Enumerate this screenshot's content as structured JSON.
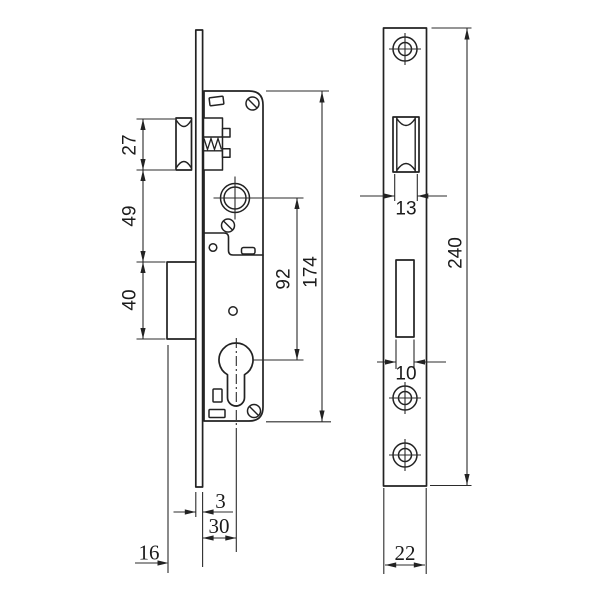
{
  "drawing_title": "mortise lock dimension drawing",
  "colors": {
    "line": "#222222",
    "background": "#ffffff"
  },
  "side_view": {
    "name": "lock body side view",
    "dims": {
      "latch_height": "27",
      "latch_to_deadbolt": "49",
      "deadbolt_height": "40",
      "follower_to_cylinder": "92",
      "case_height": "174",
      "faceplate_thickness": "3",
      "backset": "30",
      "deadbolt_throw": "16"
    }
  },
  "front_view": {
    "name": "faceplate front view",
    "dims": {
      "latch_opening_width": "13",
      "faceplate_length": "240",
      "deadbolt_opening_width": "10",
      "faceplate_width": "22"
    }
  }
}
